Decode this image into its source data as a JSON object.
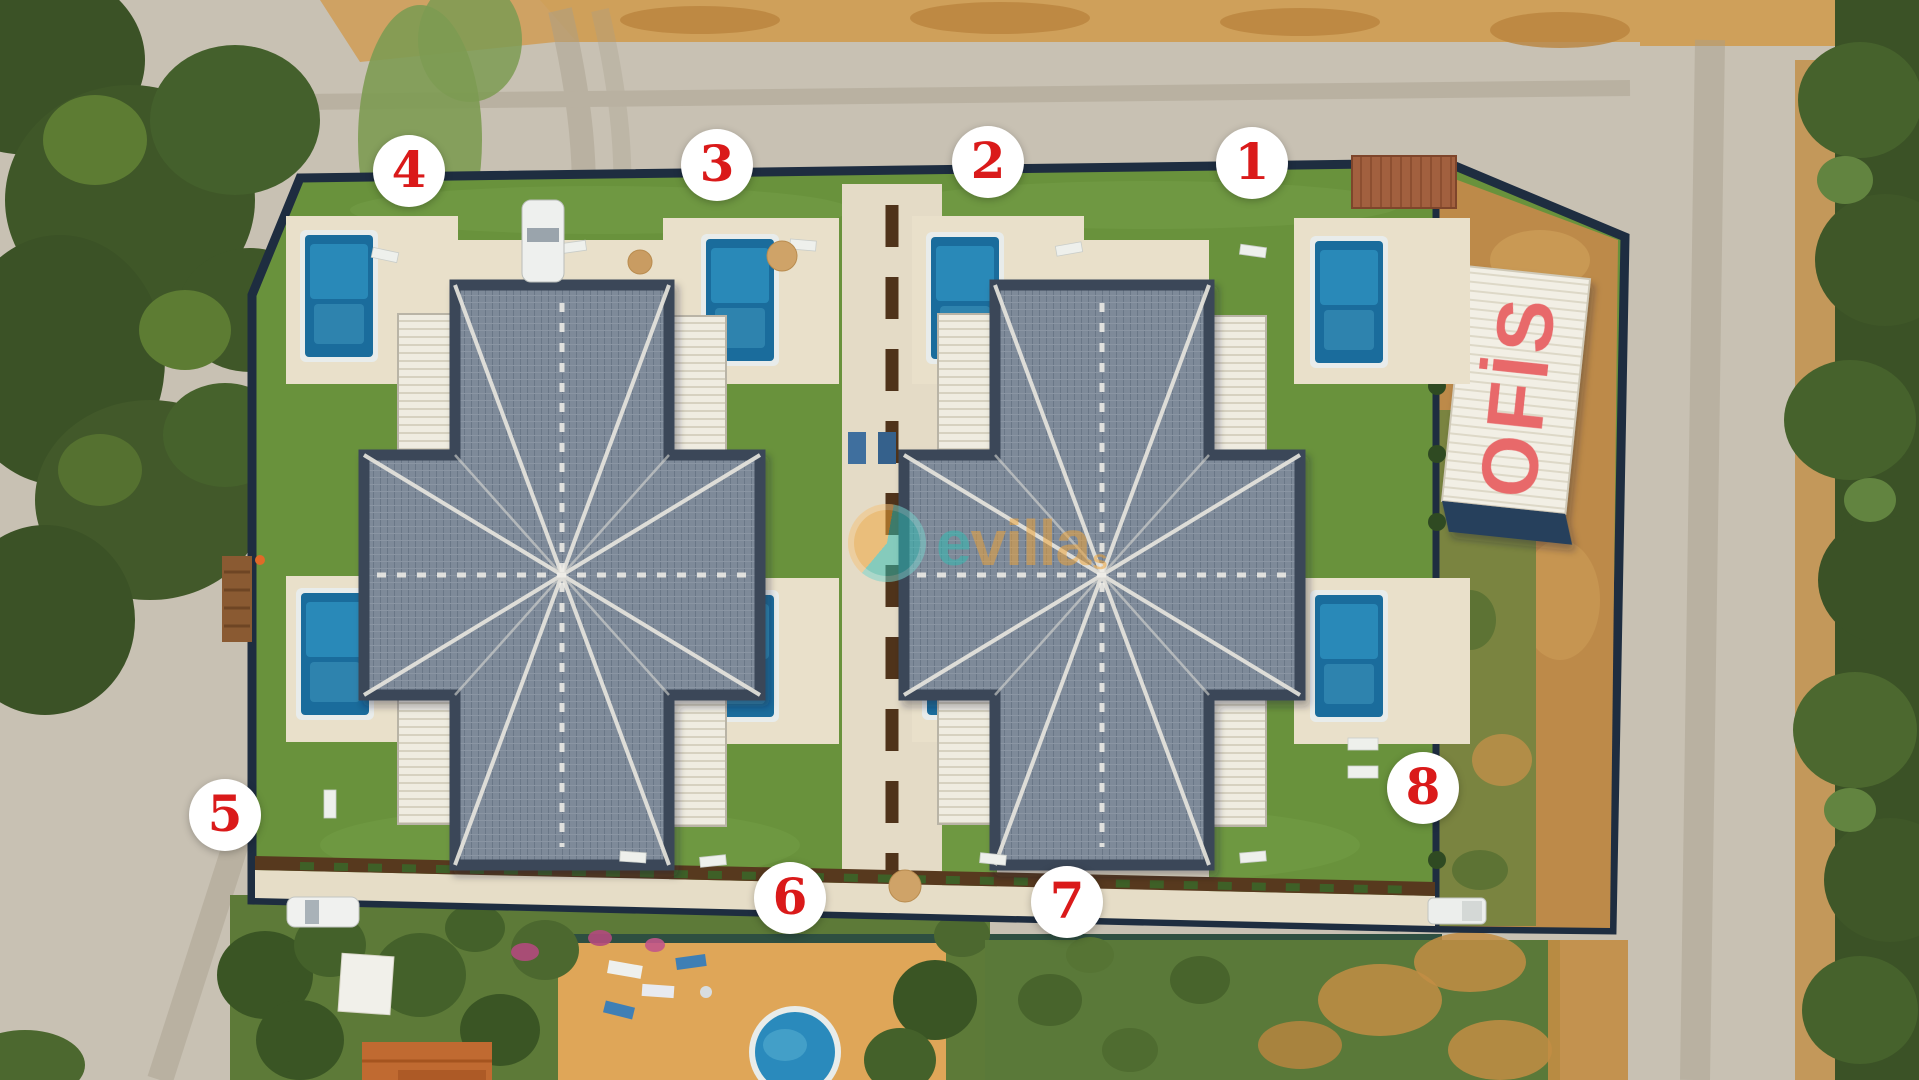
{
  "scene_title": "Aerial drone photo of a twin-villa holiday complex with numbered units",
  "markers": [
    {
      "label": "1"
    },
    {
      "label": "2"
    },
    {
      "label": "3"
    },
    {
      "label": "4"
    },
    {
      "label": "5"
    },
    {
      "label": "6"
    },
    {
      "label": "7"
    },
    {
      "label": "8"
    }
  ],
  "marker_style": {
    "background": "#ffffff",
    "text_color": "#da1a1a"
  },
  "office_sign": {
    "label": "OFİS",
    "text_color": "#e8696b",
    "roof_color": "#f2efe5"
  },
  "watermark": {
    "text_primary": "e",
    "text_secondary": "villa",
    "text_suffix": "s",
    "color_primary": "#2fbdb3",
    "color_secondary": "#f0a437"
  },
  "palette": {
    "gravel_road": "#c8c1b3",
    "dirt_orange": "#cfa05a",
    "trees_dark_green": "#3b5226",
    "lawn_green": "#69923c",
    "scrub_green": "#7a8440",
    "pool_blue": "#1a6c9c",
    "pool_light_blue": "#2f93c2",
    "roof_gray": "#7e8a99",
    "wall_navy": "#1e2d40",
    "terrace_beige": "#e9e0ca",
    "planter_brown": "#57391e",
    "carport_roof": "#a2603f",
    "house_roof_orange": "#c06a31"
  }
}
